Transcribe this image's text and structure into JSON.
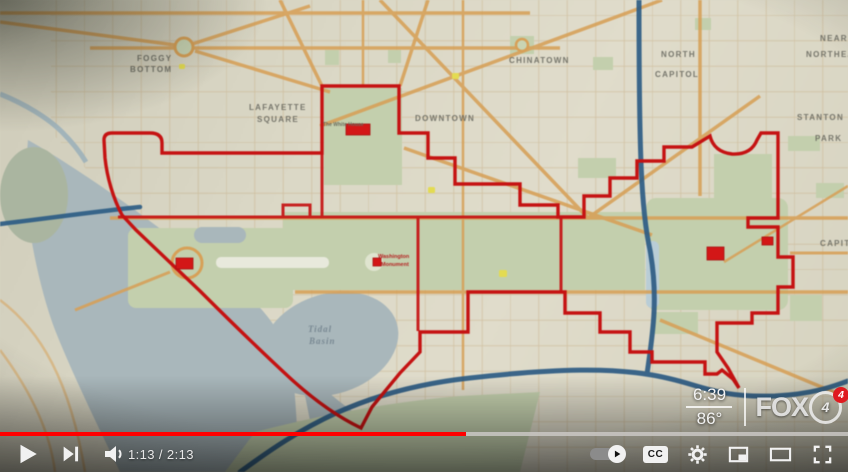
{
  "player": {
    "time_display": "1:13 / 2:13",
    "progress_played_percent": 54.9,
    "cc_label": "CC"
  },
  "station_overlay": {
    "clock": "6:39",
    "temperature": "86°",
    "station_name": "FOX",
    "channel_number": "4",
    "badge_number": "4"
  },
  "map": {
    "neighborhood_labels": [
      {
        "text": "FOGGY",
        "x": 137,
        "y": 54
      },
      {
        "text": "BOTTOM",
        "x": 130,
        "y": 65
      },
      {
        "text": "LAFAYETTE",
        "x": 249,
        "y": 103
      },
      {
        "text": "SQUARE",
        "x": 257,
        "y": 115
      },
      {
        "text": "CHINATOWN",
        "x": 509,
        "y": 56
      },
      {
        "text": "DOWNTOWN",
        "x": 415,
        "y": 114
      },
      {
        "text": "NORTH",
        "x": 661,
        "y": 50
      },
      {
        "text": "CAPITOL",
        "x": 655,
        "y": 70
      },
      {
        "text": "NEAR",
        "x": 820,
        "y": 34
      },
      {
        "text": "NORTHEAST",
        "x": 806,
        "y": 50
      },
      {
        "text": "STANTON",
        "x": 797,
        "y": 113
      },
      {
        "text": "PARK",
        "x": 815,
        "y": 134
      },
      {
        "text": "CAPITOL",
        "x": 820,
        "y": 239
      }
    ],
    "water_labels": [
      {
        "text": "Tidal",
        "x": 308,
        "y": 324
      },
      {
        "text": "Basin",
        "x": 309,
        "y": 336
      }
    ],
    "poi_labels": [
      {
        "text": "Washington",
        "x": 378,
        "y": 254
      },
      {
        "text": "Monument",
        "x": 381,
        "y": 262
      },
      {
        "text": "The White House",
        "x": 323,
        "y": 122
      }
    ],
    "colors": {
      "boundary_red": "#c51212",
      "marker_red": "#d31717",
      "park_green": "#c3cfad",
      "water_gray_blue": "#a9b7bb",
      "road_orange": "#d7a057",
      "highway_blue": "#2d5c84",
      "poi_yellow": "#e3db52"
    }
  }
}
